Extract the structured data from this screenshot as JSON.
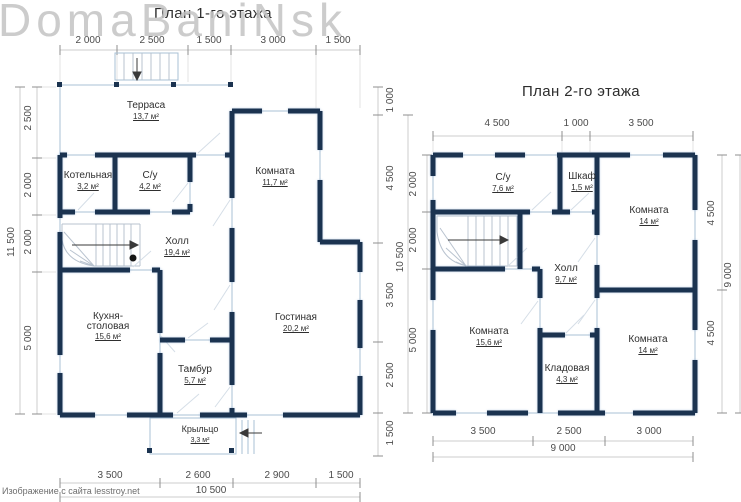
{
  "watermark": "DomaBaniNsk",
  "credit": "Изображение с сайта lesstroy.net",
  "colors": {
    "wall": "#1b3350",
    "dim_text": "#4c4c4c",
    "watermark": "#c4c4c4"
  },
  "floor1": {
    "title": "План 1-го этажа",
    "rooms": {
      "terrace": {
        "name": "Терраса",
        "area": "13,7 м²"
      },
      "boiler": {
        "name": "Котельная",
        "area": "3,2 м²"
      },
      "bath": {
        "name": "С/у",
        "area": "4,2 м²"
      },
      "room": {
        "name": "Комната",
        "area": "11,7 м²"
      },
      "hall": {
        "name": "Холл",
        "area": "19,4 м²"
      },
      "kitchen": {
        "name": "Кухня-столовая",
        "area": "15,6 м²"
      },
      "living": {
        "name": "Гостиная",
        "area": "20,2 м²"
      },
      "vestibule": {
        "name": "Тамбур",
        "area": "5,7 м²"
      },
      "porch": {
        "name": "Крыльцо",
        "area": "3,3 м²"
      }
    },
    "dims": {
      "top": [
        "2 000",
        "2 500",
        "1 500",
        "3 000",
        "1 500"
      ],
      "bottom": [
        "3 500",
        "2 600",
        "2 900",
        "1 500"
      ],
      "bottom_total": "10 500",
      "left": [
        "2 500",
        "2 000",
        "2 000",
        "5 000"
      ],
      "left_total": "11 500",
      "right": [
        "1 000",
        "4 500",
        "3 500",
        "2 500",
        "1 500"
      ],
      "right_total": "10 500"
    }
  },
  "floor2": {
    "title": "План 2-го этажа",
    "rooms": {
      "bath": {
        "name": "С/у",
        "area": "7,6 м²"
      },
      "closet": {
        "name": "Шкаф",
        "area": "1,5 м²"
      },
      "room_top": {
        "name": "Комната",
        "area": "14 м²"
      },
      "hall": {
        "name": "Холл",
        "area": "9,7 м²"
      },
      "room_left": {
        "name": "Комната",
        "area": "15,6 м²"
      },
      "storage": {
        "name": "Кладовая",
        "area": "4,3 м²"
      },
      "room_right": {
        "name": "Комната",
        "area": "14 м²"
      }
    },
    "dims": {
      "top": [
        "4 500",
        "1 000",
        "3 500"
      ],
      "bottom": [
        "3 500",
        "2 500",
        "3 000"
      ],
      "bottom_total": "9 000",
      "left": [
        "2 000",
        "2 000",
        "5 000"
      ],
      "right": [
        "4 500",
        "4 500"
      ],
      "right_total": "9 000"
    }
  }
}
